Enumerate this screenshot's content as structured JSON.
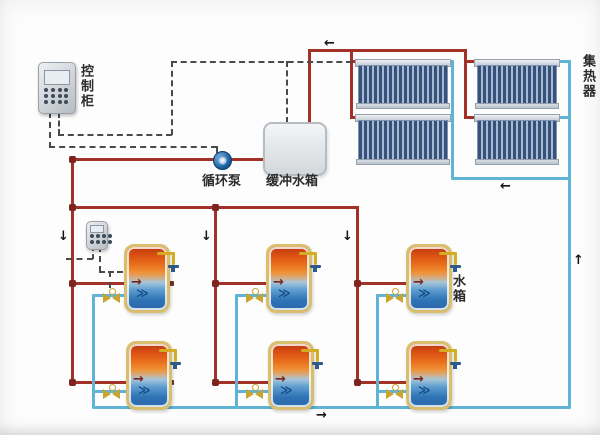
{
  "labels": {
    "control_cabinet": "控制柜",
    "circulation_pump": "循环泵",
    "buffer_tank": "缓冲水箱",
    "collector": "集热器",
    "water_tank": "水箱"
  },
  "glyphs": {
    "arrow_left": "←",
    "arrow_right": "→",
    "arrow_up": "↑",
    "arrow_down": "↓",
    "tank_flow_hot": "→",
    "tank_flow_cold": "≫"
  },
  "colors": {
    "hot": "#a23127",
    "cold": "#5fb3d4",
    "wire": "#4a4a4a",
    "shell": "#d8be6d",
    "valve": "#c9a42e",
    "pump": "#1a5fa0"
  },
  "components": {
    "solar_collector_panels": 4,
    "storage_tanks": 6
  }
}
